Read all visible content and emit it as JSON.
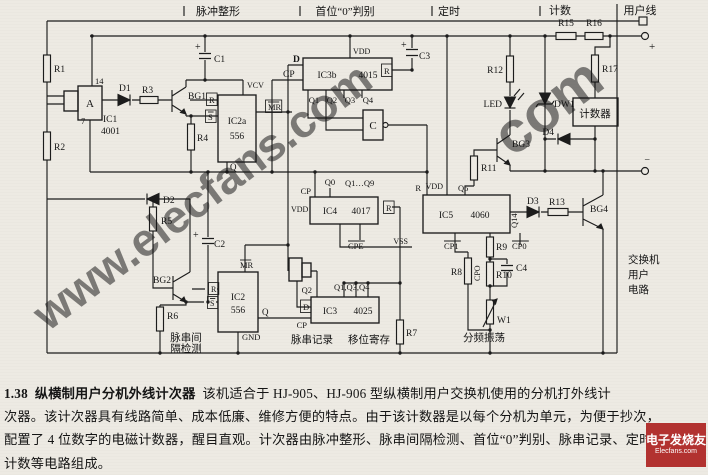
{
  "watermarks": {
    "diagonal_text": "www.elecfans.com",
    "fragment_text": "com",
    "color": "#e04040"
  },
  "logo": {
    "line1": "电子发烧友",
    "line2": "Elecfans.com"
  },
  "caption": {
    "number": "1.38",
    "title": "纵横制用户分机外线计次器",
    "line1_rest": "该机适合于 HJ-905、HJ-906 型纵横制用户交换机使用的分机打外线计",
    "line2": "次器。该计次器具有线路简单、成本低廉、维修方便的特点。由于该计数器是以每个分机为单元，为便于抄次，",
    "line3": "配置了 4 位数字的电磁计数器，醒目直观。计次器由脉冲整形、脉串间隔检测、首位“0”判别、脉串记录、定时及",
    "line4": "计数等电路组成。"
  },
  "schematic": {
    "labels": [
      {
        "id": "hdr-pulse-shaping",
        "t": "脉冲整形",
        "x": 218,
        "y": 15,
        "s": 11,
        "a": "m"
      },
      {
        "id": "hdr-first-zero",
        "t": "首位“0”判别",
        "x": 345,
        "y": 15,
        "s": 11,
        "a": "m"
      },
      {
        "id": "hdr-timing",
        "t": "定时",
        "x": 449,
        "y": 15,
        "s": 11,
        "a": "m"
      },
      {
        "id": "hdr-counting",
        "t": "计数",
        "x": 560,
        "y": 14,
        "s": 11,
        "a": "m"
      },
      {
        "id": "hdr-subscriber-line",
        "t": "用户线",
        "x": 640,
        "y": 14,
        "s": 11,
        "a": "m"
      },
      {
        "id": "R1",
        "t": "R1",
        "x": 54,
        "y": 72,
        "s": 9.5
      },
      {
        "id": "R2",
        "t": "R2",
        "x": 54,
        "y": 150,
        "s": 9.5
      },
      {
        "id": "pin14",
        "t": "14",
        "x": 95,
        "y": 84,
        "s": 8.5
      },
      {
        "id": "pin7",
        "t": "7",
        "x": 81,
        "y": 124,
        "s": 8.5
      },
      {
        "id": "IC1",
        "t": "IC1",
        "x": 103,
        "y": 122,
        "s": 9.5
      },
      {
        "id": "IC1-part",
        "t": "4001",
        "x": 101,
        "y": 134,
        "s": 9.5
      },
      {
        "id": "gateA",
        "t": "A",
        "x": 90,
        "y": 107,
        "s": 11,
        "a": "m"
      },
      {
        "id": "D1",
        "t": "D1",
        "x": 119,
        "y": 91,
        "s": 9.5
      },
      {
        "id": "R3",
        "t": "R3",
        "x": 142,
        "y": 93,
        "s": 9.5
      },
      {
        "id": "BG1",
        "t": "BG1",
        "x": 188,
        "y": 99,
        "s": 9.5
      },
      {
        "id": "C1-plus",
        "t": "+",
        "x": 195,
        "y": 50,
        "s": 10
      },
      {
        "id": "C1",
        "t": "C1",
        "x": 214,
        "y": 62,
        "s": 9.5
      },
      {
        "id": "R4",
        "t": "R4",
        "x": 197,
        "y": 141,
        "s": 9.5
      },
      {
        "id": "IC2a",
        "t": "IC2a",
        "x": 237,
        "y": 124,
        "s": 9.5,
        "a": "m"
      },
      {
        "id": "IC2a-part",
        "t": "556",
        "x": 237,
        "y": 139,
        "s": 9.5,
        "a": "m"
      },
      {
        "id": "VCV",
        "t": "VCV",
        "x": 247,
        "y": 88,
        "s": 8
      },
      {
        "id": "IC2a-R",
        "t": "R",
        "x": 209,
        "y": 103,
        "s": 8.5,
        "box": 1
      },
      {
        "id": "IC2a-S",
        "t": "S",
        "x": 208,
        "y": 120,
        "s": 8.5,
        "box": 1,
        "ol": 1
      },
      {
        "id": "IC2a-MR",
        "t": "MR",
        "x": 268,
        "y": 110,
        "s": 8.5,
        "box": 1,
        "ol": 1
      },
      {
        "id": "IC2a-Q",
        "t": "Q",
        "x": 230,
        "y": 170,
        "s": 9
      },
      {
        "id": "IC3b-D",
        "t": "D",
        "x": 293,
        "y": 62,
        "s": 9.5,
        "b": 1
      },
      {
        "id": "IC3b-CP",
        "t": "CP",
        "x": 283,
        "y": 77,
        "s": 9.5
      },
      {
        "id": "IC3b",
        "t": "IC3b",
        "x": 327,
        "y": 78,
        "s": 9.5,
        "a": "m"
      },
      {
        "id": "IC3b-part",
        "t": "4015",
        "x": 368,
        "y": 78,
        "s": 9.5,
        "a": "m"
      },
      {
        "id": "IC3b-VDD",
        "t": "VDD",
        "x": 353,
        "y": 54,
        "s": 8
      },
      {
        "id": "IC3b-R",
        "t": "R",
        "x": 384,
        "y": 74,
        "s": 8.5,
        "box": 1
      },
      {
        "id": "C3-plus",
        "t": "+",
        "x": 401,
        "y": 48,
        "s": 10
      },
      {
        "id": "C3",
        "t": "C3",
        "x": 419,
        "y": 59,
        "s": 9.5
      },
      {
        "id": "Q1-out",
        "t": "Q1",
        "x": 314,
        "y": 103,
        "s": 8.5,
        "a": "m"
      },
      {
        "id": "Q2-out",
        "t": "Q2",
        "x": 332,
        "y": 103,
        "s": 8.5,
        "a": "m"
      },
      {
        "id": "Q3-out",
        "t": "Q3",
        "x": 350,
        "y": 103,
        "s": 8.5,
        "a": "m"
      },
      {
        "id": "Q4-out",
        "t": "Q4",
        "x": 368,
        "y": 103,
        "s": 8.5,
        "a": "m"
      },
      {
        "id": "gateC",
        "t": "C",
        "x": 373,
        "y": 129,
        "s": 11,
        "a": "m"
      },
      {
        "id": "IC4",
        "t": "IC4",
        "x": 330,
        "y": 214,
        "s": 9.5,
        "a": "m"
      },
      {
        "id": "IC4-part",
        "t": "4017",
        "x": 361,
        "y": 214,
        "s": 9.5,
        "a": "m"
      },
      {
        "id": "IC4-CP",
        "t": "CP",
        "x": 311,
        "y": 194,
        "s": 8.5,
        "a": "e"
      },
      {
        "id": "IC4-Q0",
        "t": "Q0",
        "x": 330,
        "y": 185,
        "s": 8.5,
        "a": "m"
      },
      {
        "id": "IC4-Q1-Q9",
        "t": "Q1…Q9",
        "x": 345,
        "y": 186,
        "s": 8.5
      },
      {
        "id": "IC4-VDD",
        "t": "VDD",
        "x": 291,
        "y": 212,
        "s": 8
      },
      {
        "id": "IC4-R",
        "t": "R",
        "x": 386,
        "y": 211,
        "s": 8.5,
        "box": 1
      },
      {
        "id": "IC4-CPE",
        "t": "CPE",
        "x": 348,
        "y": 249,
        "s": 8.5,
        "ol": 1
      },
      {
        "id": "IC4-VSS",
        "t": "VSS",
        "x": 408,
        "y": 244,
        "s": 8,
        "a": "e"
      },
      {
        "id": "IC5",
        "t": "IC5",
        "x": 446,
        "y": 218,
        "s": 9.5,
        "a": "m"
      },
      {
        "id": "IC5-part",
        "t": "4060",
        "x": 480,
        "y": 218,
        "s": 9.5,
        "a": "m"
      },
      {
        "id": "IC5-R",
        "t": "R",
        "x": 421,
        "y": 191,
        "s": 8.5,
        "a": "e"
      },
      {
        "id": "IC5-VDD",
        "t": "VDD",
        "x": 443,
        "y": 189,
        "s": 8,
        "a": "e"
      },
      {
        "id": "IC5-Q5",
        "t": "Q5",
        "x": 458,
        "y": 191,
        "s": 8.5
      },
      {
        "id": "IC5-Q14",
        "t": "Q14",
        "x": 517,
        "y": 228,
        "s": 8.5,
        "r": -90
      },
      {
        "id": "IC5-CP1",
        "t": "CP1",
        "x": 444,
        "y": 249,
        "s": 8.5,
        "ol": 1
      },
      {
        "id": "IC5-CP0",
        "t": "CP0",
        "x": 512,
        "y": 249,
        "s": 8.5,
        "ol": 1
      },
      {
        "id": "CPO-vert",
        "t": "CPO",
        "x": 480,
        "y": 281,
        "s": 8,
        "r": -90
      },
      {
        "id": "R8",
        "t": "R8",
        "x": 462,
        "y": 275,
        "s": 9.5,
        "a": "e"
      },
      {
        "id": "R9",
        "t": "R9",
        "x": 496,
        "y": 250,
        "s": 9.5
      },
      {
        "id": "R10",
        "t": "R10",
        "x": 496,
        "y": 278,
        "s": 9.5
      },
      {
        "id": "C4",
        "t": "C4",
        "x": 516,
        "y": 271,
        "s": 9.5
      },
      {
        "id": "W1",
        "t": "W1",
        "x": 497,
        "y": 323,
        "s": 9.5
      },
      {
        "id": "lbl-divider-osc",
        "t": "分频振荡",
        "x": 484,
        "y": 341,
        "s": 10.5,
        "a": "m"
      },
      {
        "id": "R7",
        "t": "R7",
        "x": 406,
        "y": 336,
        "s": 9.5
      },
      {
        "id": "IC3-Q2",
        "t": "Q2",
        "x": 312,
        "y": 293,
        "s": 8.5,
        "a": "e"
      },
      {
        "id": "IC3-Q134",
        "t": "Q1,Q3,Q4",
        "x": 334,
        "y": 290,
        "s": 8.5
      },
      {
        "id": "IC3-D",
        "t": "D",
        "x": 303,
        "y": 310,
        "s": 8.5,
        "box": 1
      },
      {
        "id": "IC3-CP",
        "t": "CP",
        "x": 307,
        "y": 328,
        "s": 8.5,
        "a": "e"
      },
      {
        "id": "IC3",
        "t": "IC3",
        "x": 330,
        "y": 314,
        "s": 9.5,
        "a": "m"
      },
      {
        "id": "IC3-part",
        "t": "4025",
        "x": 363,
        "y": 314,
        "s": 9.5,
        "a": "m"
      },
      {
        "id": "lbl-pulse-record",
        "t": "脉串记录",
        "x": 312,
        "y": 343,
        "s": 10.5,
        "a": "m"
      },
      {
        "id": "lbl-shift-register",
        "t": "移位寄存",
        "x": 369,
        "y": 343,
        "s": 10.5,
        "a": "m"
      },
      {
        "id": "IC2-MR",
        "t": "MR",
        "x": 240,
        "y": 268,
        "s": 8.5,
        "ol": 1
      },
      {
        "id": "IC2",
        "t": "IC2",
        "x": 238,
        "y": 300,
        "s": 9.5,
        "a": "m"
      },
      {
        "id": "IC2-part",
        "t": "556",
        "x": 238,
        "y": 313,
        "s": 9.5,
        "a": "m"
      },
      {
        "id": "IC2-R",
        "t": "R",
        "x": 211,
        "y": 292,
        "s": 8,
        "box": 1
      },
      {
        "id": "IC2-S",
        "t": "S",
        "x": 210,
        "y": 306,
        "s": 8,
        "box": 1,
        "ol": 1
      },
      {
        "id": "IC2-Q",
        "t": "Q",
        "x": 262,
        "y": 315,
        "s": 9
      },
      {
        "id": "GND",
        "t": "GND",
        "x": 242,
        "y": 340,
        "s": 8.5
      },
      {
        "id": "BG2",
        "t": "BG2",
        "x": 171,
        "y": 283,
        "s": 9.5,
        "a": "e"
      },
      {
        "id": "R6",
        "t": "R6",
        "x": 167,
        "y": 319,
        "s": 9.5
      },
      {
        "id": "lbl-detect-1",
        "t": "脉串间",
        "x": 186,
        "y": 341,
        "s": 10.5,
        "a": "m"
      },
      {
        "id": "lbl-detect-2",
        "t": "隔检测",
        "x": 186,
        "y": 352,
        "s": 10.5,
        "a": "m"
      },
      {
        "id": "D2",
        "t": "D2",
        "x": 163,
        "y": 203,
        "s": 9.5
      },
      {
        "id": "R5",
        "t": "R5",
        "x": 161,
        "y": 224,
        "s": 9.5
      },
      {
        "id": "C2-plus",
        "t": "+",
        "x": 193,
        "y": 238,
        "s": 10
      },
      {
        "id": "C2",
        "t": "C2",
        "x": 214,
        "y": 247,
        "s": 9.5
      },
      {
        "id": "BG3",
        "t": "BG3",
        "x": 512,
        "y": 147,
        "s": 9.5
      },
      {
        "id": "R11",
        "t": "R11",
        "x": 481,
        "y": 171,
        "s": 9.5
      },
      {
        "id": "R12",
        "t": "R12",
        "x": 503,
        "y": 73,
        "s": 9.5,
        "a": "e"
      },
      {
        "id": "LED",
        "t": "LED",
        "x": 502,
        "y": 107,
        "s": 9.5,
        "a": "e"
      },
      {
        "id": "DW1",
        "t": "DW1",
        "x": 554,
        "y": 107,
        "s": 9.5
      },
      {
        "id": "lbl-counter",
        "t": "计数器",
        "x": 595,
        "y": 117,
        "s": 10.5,
        "a": "m"
      },
      {
        "id": "D4",
        "t": "D4",
        "x": 554,
        "y": 135,
        "s": 9.5,
        "a": "e"
      },
      {
        "id": "R15",
        "t": "R15",
        "x": 566,
        "y": 26,
        "s": 9.5,
        "a": "m"
      },
      {
        "id": "R16",
        "t": "R16",
        "x": 594,
        "y": 26,
        "s": 9.5,
        "a": "m"
      },
      {
        "id": "R17",
        "t": "R17",
        "x": 602,
        "y": 72,
        "s": 9.5
      },
      {
        "id": "D3",
        "t": "D3",
        "x": 527,
        "y": 204,
        "s": 9.5
      },
      {
        "id": "R13",
        "t": "R13",
        "x": 549,
        "y": 205,
        "s": 9.5
      },
      {
        "id": "BG4",
        "t": "BG4",
        "x": 590,
        "y": 212,
        "s": 9.5
      },
      {
        "id": "term-plus",
        "t": "+",
        "x": 649,
        "y": 50,
        "s": 11
      },
      {
        "id": "term-minus",
        "t": "−",
        "x": 650,
        "y": 163,
        "s": 10,
        "a": "e"
      },
      {
        "id": "lbl-exchange-1",
        "t": "交换机",
        "x": 628,
        "y": 263,
        "s": 10.5
      },
      {
        "id": "lbl-exchange-2",
        "t": "用户",
        "x": 628,
        "y": 278,
        "s": 10.5
      },
      {
        "id": "lbl-exchange-3",
        "t": "电路",
        "x": 628,
        "y": 293,
        "s": 10.5
      }
    ]
  }
}
